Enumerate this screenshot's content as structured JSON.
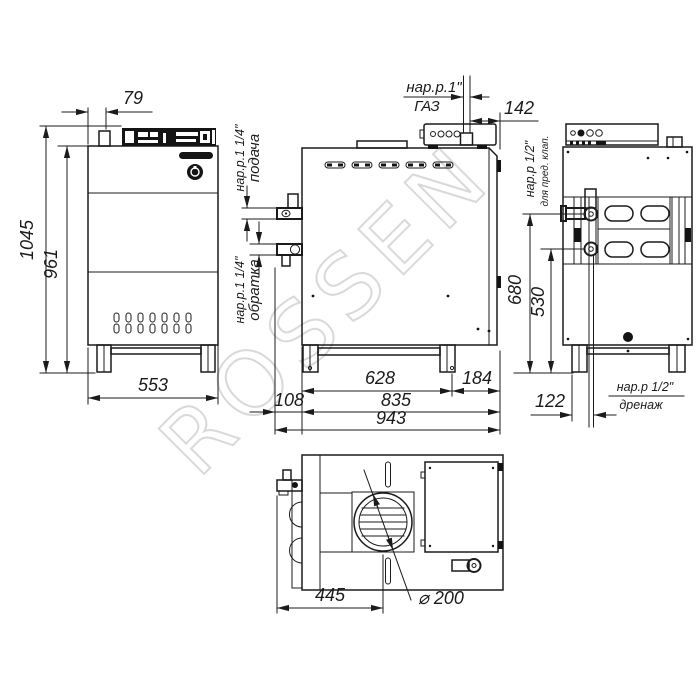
{
  "watermark": "ROSSEN",
  "front_view": {
    "dim_top_offset": "79",
    "dim_height_total": "1045",
    "dim_height_body": "961",
    "dim_width": "553"
  },
  "side_view": {
    "gas_thread": "нар.р.1\"",
    "gas_label": "ГАЗ",
    "dim_gas_offset": "142",
    "supply_thread": "нар.р.1 1/4\"",
    "supply_label": "подача",
    "return_thread": "нар.р.1 1/4\"",
    "return_label": "обратка",
    "dim_leg_span": "628",
    "dim_leg_to_back": "184",
    "dim_front_offset": "108",
    "dim_depth": "835",
    "dim_depth_total": "943"
  },
  "back_view": {
    "valve_thread": "нар.р 1/2\"",
    "valve_note": "для пред. клап.",
    "dim_valve_height": "680",
    "dim_drain_height": "530",
    "dim_drain_offset": "122",
    "drain_thread": "нар.р 1/2\"",
    "drain_label": "дренаж"
  },
  "top_view": {
    "dim_flue_offset": "445",
    "dim_flue_diameter": "⌀ 200"
  }
}
